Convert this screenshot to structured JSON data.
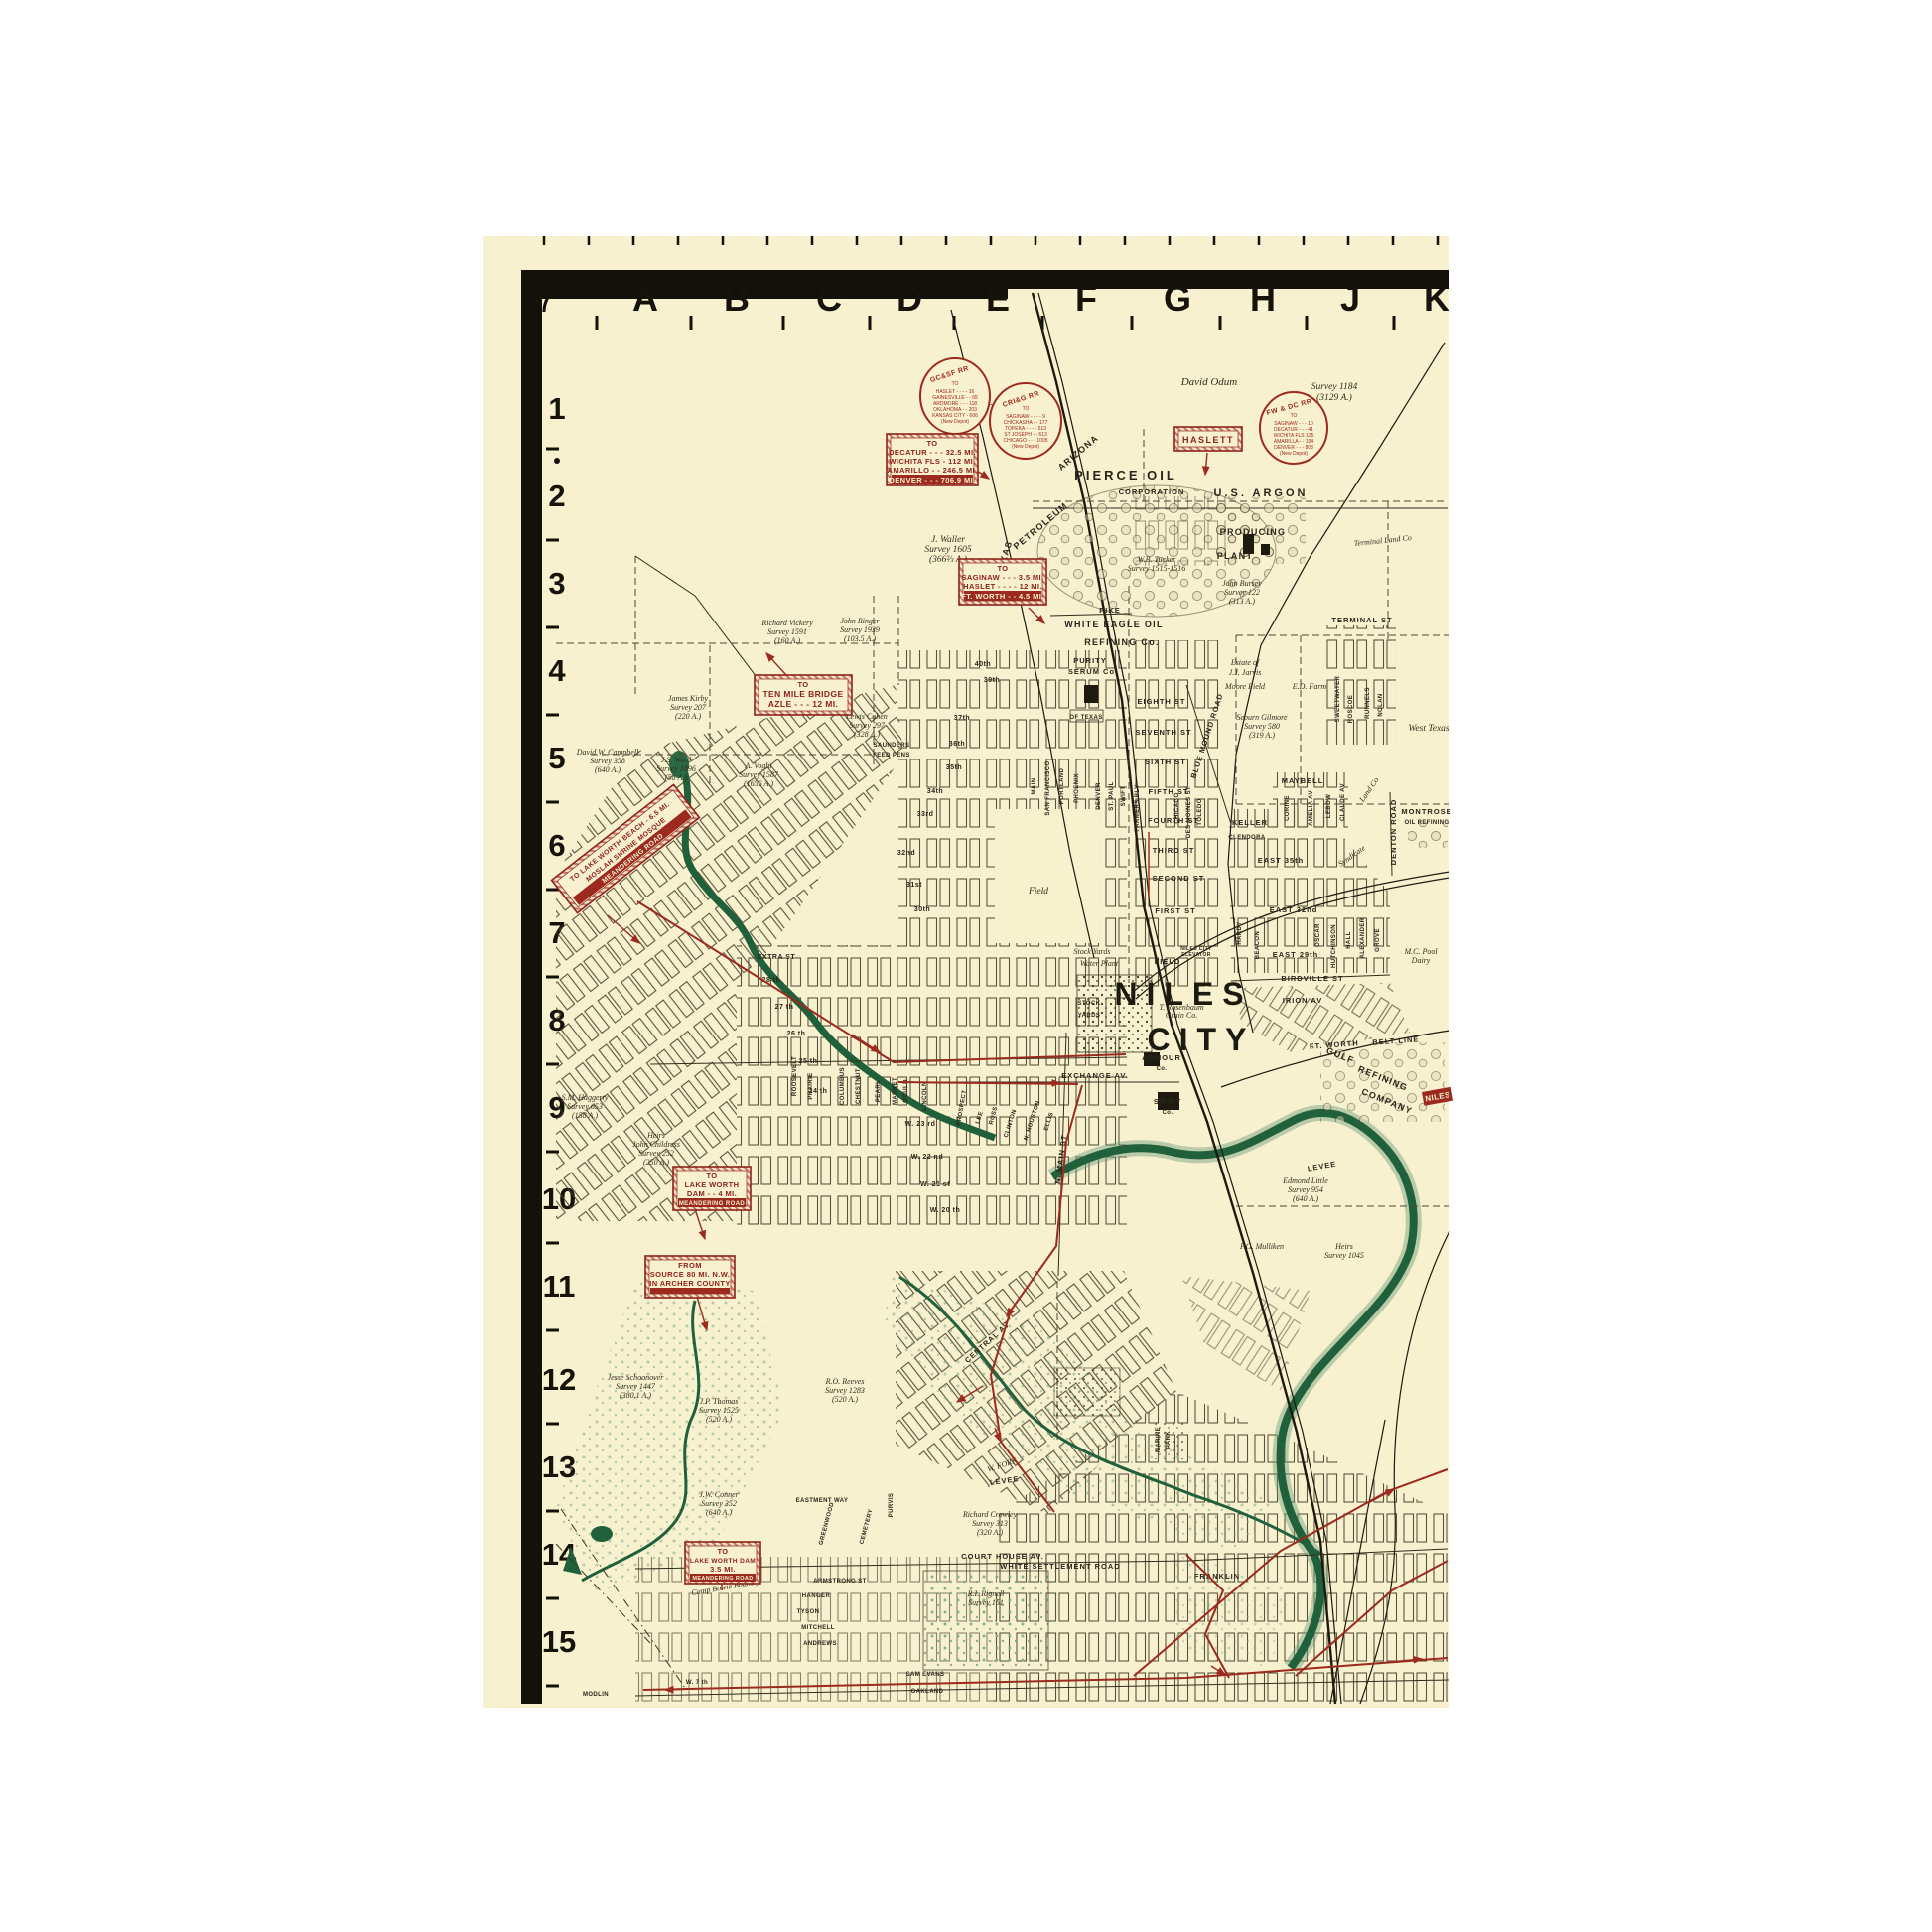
{
  "grid": {
    "letters": [
      "A",
      "B",
      "C",
      "D",
      "E",
      "F",
      "G",
      "H",
      "J",
      "K"
    ],
    "numbers": [
      "1",
      "2",
      "3",
      "4",
      "5",
      "6",
      "7",
      "8",
      "9",
      "10",
      "11",
      "12",
      "13",
      "14",
      "15"
    ]
  },
  "rail_circles": [
    {
      "name": "GC&SF RR",
      "to": "TO",
      "lines": [
        "HASLET - - - - 16",
        "GAINESVILLE - - 65",
        "ARDMORE - - - 118",
        "OKLAHOMA - - 203",
        "KANSAS CITY - 606",
        "(New Depot)"
      ]
    },
    {
      "name": "CRI&G RR",
      "to": "TO",
      "lines": [
        "SAGINAW - - - - 9",
        "CHICKASHA - - 177",
        "TOPEKA - - - - 513",
        "ST JOSEPH - - 613",
        "CHICAGO - - - 1005",
        "(New Depot)"
      ]
    },
    {
      "name": "FW & DC RR",
      "to": "TO",
      "lines": [
        "SAGINAW - - - 10",
        "DECATUR - - - 41",
        "WICHITA FLS 125",
        "AMARILLA - - 194",
        "DENVER - - - 803",
        "(New Depot)"
      ]
    }
  ],
  "road_signs": [
    {
      "id": "decatur",
      "lines": [
        "TO",
        "DECATUR - - - 32.5 MI.",
        "WICHITA FLS - 112 MI.",
        "AMARILLO - - 246.5 MI."
      ],
      "band": "DENVER - - - 706.9 MI."
    },
    {
      "id": "haslett",
      "lines": [
        "HASLETT"
      ],
      "band": ""
    },
    {
      "id": "saginaw",
      "lines": [
        "TO",
        "SAGINAW - - - 3.5 MI.",
        "HASLET - - - - 12 MI."
      ],
      "band": "FT. WORTH - - 4.5 MI."
    },
    {
      "id": "ten-mile-bridge",
      "lines": [
        "TO",
        "TEN MILE BRIDGE",
        "AZLE - - - 12 MI."
      ],
      "band": ""
    },
    {
      "id": "lake-worth-beach",
      "lines": [
        "TO LAKE WORTH BEACH - 6.5 MI.",
        "MOSLAH SHRINE MOSQUE"
      ],
      "band": "MEANDERING ROAD"
    },
    {
      "id": "lake-worth-dam-4",
      "lines": [
        "TO",
        "LAKE WORTH",
        "DAM - - 4 MI."
      ],
      "band": "MEANDERING ROAD"
    },
    {
      "id": "river-source",
      "lines": [
        "FROM",
        "SOURCE 80 MI. N.W.",
        "IN ARCHER COUNTY"
      ],
      "band": ""
    },
    {
      "id": "lake-worth-dam-35",
      "lines": [
        "TO",
        "LAKE WORTH DAM",
        "3.5 MI."
      ],
      "band": "MEANDERING ROAD"
    }
  ],
  "labels": {
    "david_odum": "David Odum",
    "survey_1184": "Survey 1184",
    "survey_1184a": "(3129 A.)",
    "samg": "S.A.& M.G. R.R.Co",
    "samg2": "Survey 1464",
    "samg3": "(320 A.)",
    "terminal_land": "Terminal Land Co",
    "waller": "J. Waller",
    "waller2": "Survey 1605",
    "waller3": "(366⅔ A.)",
    "vickery": "Richard Vickery",
    "vickery2": "Survey 1591",
    "vickery3": "(160 A.)",
    "ringer": "John Ringer",
    "ringer2": "Survey 1939",
    "ringer3": "(103.5 A.)",
    "tucker": "W.B. Tucker",
    "tucker2": "Survey 1515-1516",
    "bursey": "John Bursey",
    "bursey2": "Survey 122",
    "bursey3": "(313 A.)",
    "jarvis": "Estate of",
    "jarvis2": "J.J. Jarvis",
    "jarvis3": "Moore Field",
    "ed_farm": "E.D. Farm",
    "gilmore": "Seburn Gilmore",
    "gilmore2": "Survey 580",
    "gilmore3": "(319 A.)",
    "kirby": "James Kirby",
    "kirby2": "Survey 207",
    "kirby3": "(220 A.)",
    "cohen": "Lewis Cohen",
    "cohen2": "Survey 297",
    "cohen3": "(328 A.)",
    "saunders": "SAUNDERS",
    "feed_pens": "FEED PENS",
    "campbell": "David W. Campbell",
    "campbell2": "Survey 358",
    "campbell3": "(640 A.)",
    "ward": "J.S. Ward",
    "ward2": "Survey 1896",
    "ward3": "(58 A.)",
    "voght": "A. Voght",
    "voght2": "Survey 1587",
    "voght3": "(1656 A.)",
    "haggerty": "S.M. Haggerty",
    "haggerty2": "Survey 653",
    "haggerty3": "(158 A.)",
    "childress": "Heirs",
    "childress2": "John Childress",
    "childress3": "Survey 252",
    "childress4": "(250 A.)",
    "schoonover": "Jesse Schoonover",
    "schoonover2": "Survey 1447",
    "schoonover3": "(380.1 A.)",
    "thomas": "J.P. Thomas",
    "thomas2": "Survey 1525",
    "thomas3": "(520 A.)",
    "reeves": "R.O. Reeves",
    "reeves2": "Survey 1283",
    "reeves3": "(520 A.)",
    "conner": "J.W. Conner",
    "conner2": "Survey 352",
    "conner3": "(640 A.)",
    "crowley": "Richard Crowley",
    "crowley2": "Survey 313",
    "crowley3": "(320 A.)",
    "little": "Edmond Little",
    "little2": "Survey 954",
    "little3": "(640 A.)",
    "mulliken": "F.G. Mulliken",
    "heirs1045": "Heirs",
    "heirs1045b": "Survey 1045",
    "rignell": "R.I. Rignell",
    "rignell2": "Survey 151",
    "camp_bowie": "Camp Bowie Bound'y",
    "west_texas": "West Texas",
    "pool_dairy": "M.C. Pool",
    "pool_dairy2": "Dairy",
    "stock_yards_it": "Stock Yards",
    "water_plant": "Water Plant",
    "rosenbaum": "T. Rosenbaum",
    "rosenbaum2": "Grain Co.",
    "field_w": "Field",
    "field_e": "FIELD",
    "niles_elev": "NILES CITY",
    "niles_elev2": "ELEVATOR",
    "w_fork": "W. FORK",
    "levee_w": "LEVEE",
    "levee_e": "LEVEE",
    "pierce": "PIERCE OIL",
    "pierce2": "CORPORATION",
    "us_argon": "U.S. ARGON",
    "producing": "PRODUCING",
    "plant": "PLANT",
    "texas_d": "TEXAS",
    "arizona_d": "ARIZONA",
    "petroleum_d": "PETROLEUM",
    "white_eagle": "WHITE EAGLE OIL",
    "white_eagle2": "REFINING Co.",
    "purity": "PURITY",
    "purity2": "SERUM Co.",
    "pike": "PIKE",
    "of_texas": "OF TEXAS",
    "niles": "NILES",
    "city": "CITY",
    "stock1": "STOCK",
    "stock2": "YARDS",
    "exchange_av": "EXCHANGE AV.",
    "swift_co": "SWIFT",
    "swift_co2": "Co.",
    "armour": "ARMOUR",
    "armour2": "Co.",
    "ft_worth": "FT. WORTH",
    "belt_line": "BELT LINE",
    "gulf": "GULF",
    "gulf2": "REFINING",
    "gulf3": "COMPANY",
    "montrose": "MONTROSE",
    "montrose2": "OIL REFINING",
    "blue_mound": "BLUE MOUND ROAD",
    "denton_road": "DENTON ROAD",
    "terminal_st": "TERMINAL ST",
    "sweetwater": "SWEETWATER",
    "roscoe": "ROSCOE",
    "runnels": "RUNNELS",
    "nolan": "NOLAN",
    "maybell": "MAYBELL",
    "corine": "CORINE",
    "amelia": "AMELIA AV",
    "lebow": "LEBOW",
    "claude": "CLAUDE AV",
    "keller": "KELLER",
    "clendora": "CLENDORA",
    "east35": "EAST 35th",
    "east32": "EAST 32nd",
    "east29": "EAST 29th",
    "birdville": "BIRDVILLE ST",
    "irion": "IRION AV",
    "hardy": "HARDY",
    "beacon": "BEACON",
    "oscar": "OSCAR",
    "hutchinson": "HUTCHINSON",
    "hall": "HALL",
    "alexander": "ALEXANDER",
    "grove": "GROVE",
    "syndicate": "Syndicate",
    "land_co": "Land Co",
    "eighth": "EIGHTH ST",
    "seventh": "SEVENTH ST",
    "sixth": "SIXTH ST",
    "fifth": "FIFTH ST",
    "fourth": "FOURTH ST",
    "third": "THIRD ST",
    "second": "SECOND ST",
    "first": "FIRST ST",
    "s40": "40th",
    "s39": "39th",
    "s37": "37th",
    "s36": "36th",
    "s35": "35th",
    "s34": "34th",
    "s33": "33rd",
    "s32": "32nd",
    "s31": "31st",
    "s30": "30th",
    "extra": "EXTRA ST",
    "s28": "28 th",
    "s27": "27 th",
    "s26": "26 th",
    "s25": "25 th",
    "s24": "24 th",
    "w23": "W. 23 rd",
    "w22": "W. 22 nd",
    "w21": "W. 21 st",
    "w20": "W. 20 th",
    "main_av": "MAIN",
    "san_francisco": "SAN FRANCISCO",
    "portland": "PORTLAND",
    "phoenix": "PHOENIX",
    "denver_av": "DENVER",
    "st_paul": "ST. PAUL",
    "swift_av": "SWIFT",
    "farmers": "FARMERS BLV",
    "chicago_av": "CHICAGO",
    "des_moines": "DES MOINES ST",
    "toledo": "TOLEDO",
    "roosevelt": "ROOSEVELT",
    "prairie": "PRAIRIE",
    "columbus": "COLUMBUS",
    "chestnut": "CHESTNUT",
    "pearl": "PEARL",
    "market": "MARKET",
    "gould": "GOULD",
    "lincoln": "LINCOLN",
    "clinton": "CLINTON",
    "houston": "N. HOUSTON",
    "ellis": "ELLIS",
    "lee": "LEE",
    "prospect": "PROSPECT",
    "ross": "ROSS",
    "central": "CENTRAL AV",
    "n_main": "N. MAIN ST",
    "franklin": "FRANKLIN",
    "white_settlement": "WHITE SETTLEMENT ROAD",
    "court_house": "COURT HOUSE AV.",
    "armstrong": "ARMSTRONG ST",
    "hanger": "HANGER",
    "tyson": "TYSON",
    "mitchell": "MITCHELL",
    "andrews": "ANDREWS",
    "sam_evans": "SAM EVANS",
    "oakland": "OAKLAND",
    "modlin": "MODLIN",
    "w7th": "W. 7 th",
    "eastment": "EASTMENT WAY",
    "greenwood": "GREENWOOD",
    "cemetery": "CEMETERY",
    "purvis": "PURVIS",
    "marine1": "MARINE",
    "marine2": "PARK",
    "nile_sign": "NILES"
  }
}
